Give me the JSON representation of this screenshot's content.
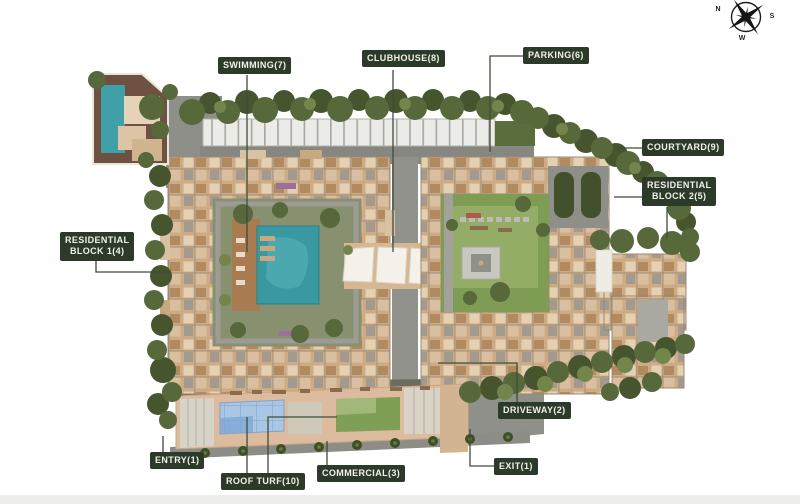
{
  "page": {
    "background": "#ffffff",
    "footer_strip_color": "#ededeb"
  },
  "compass": {
    "n": "N",
    "s": "S",
    "w": "W"
  },
  "labels": {
    "swimming": "SWIMMING(7)",
    "clubhouse": "CLUBHOUSE(8)",
    "parking": "PARKING(6)",
    "courtyard": "COURTYARD(9)",
    "residential_block_2": [
      "RESIDENTIAL",
      "BLOCK 2(5)"
    ],
    "residential_block_1": [
      "RESIDENTIAL",
      "BLOCK 1(4)"
    ],
    "driveway": "DRIVEWAY(2)",
    "entry": "ENTRY(1)",
    "roof_turf": "ROOF TURF(10)",
    "commercial": "COMMERCIAL(3)",
    "exit": "EXIT(1)"
  },
  "colors": {
    "label_bg": "#2c3b29",
    "label_text": "#f2f1ea",
    "connector": "#3f4c39",
    "pool_teal": "#3a98a0",
    "lawn_green": "#7f9c55",
    "roof_turf_green": "#7f9e56",
    "glass_blue": "#a9c6e4",
    "building_beige": "#cdab85",
    "tree_green": "#57683b",
    "road_gray": "#8d8d87",
    "deck_wood": "#a97b51"
  }
}
